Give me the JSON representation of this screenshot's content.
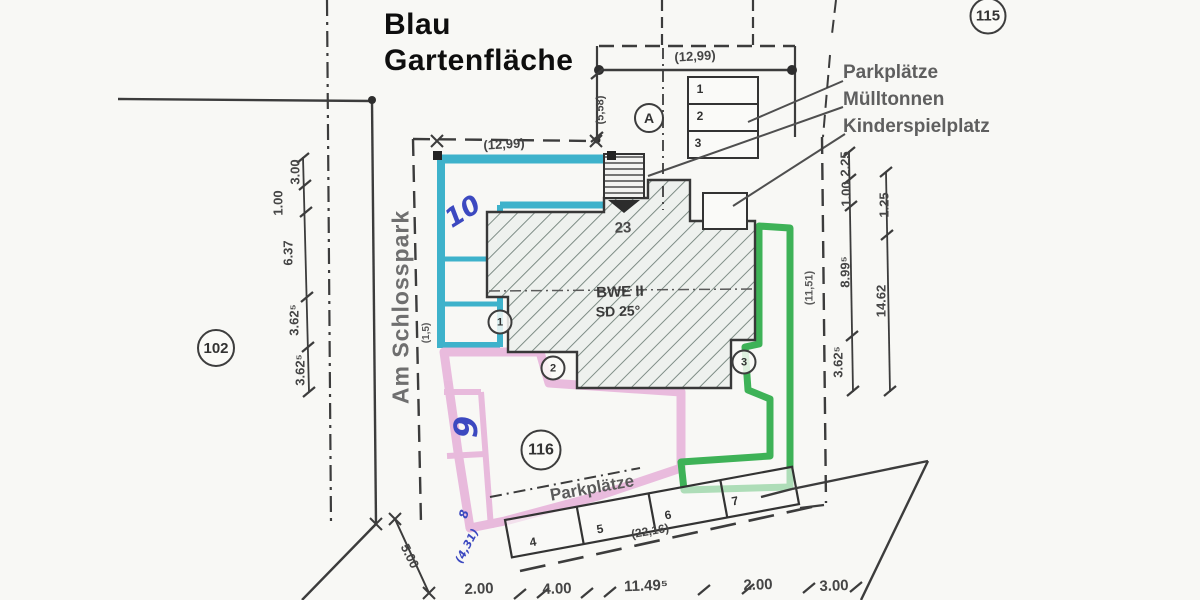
{
  "annotation": {
    "line1": "Blau",
    "line2": "Gartenfläche"
  },
  "street": {
    "name": "Am Schlosspark",
    "corner_dim": "5.00",
    "width_dim": "(1,5)"
  },
  "parcels": {
    "p115": "115",
    "p102": "102",
    "p116": "116"
  },
  "legend": {
    "parkplaetze": "Parkplätze",
    "muelltonnen": "Mülltonnen",
    "kinderspielplatz": "Kinderspielplatz"
  },
  "building": {
    "number": "23",
    "name": "BWE II",
    "roof": "SD 25°",
    "section": "A",
    "units": {
      "u1": "1",
      "u2": "2",
      "u3": "3"
    }
  },
  "parking_top": {
    "dim": "(12,99)",
    "side_dim": "(5,58)",
    "stalls": {
      "s1": "1",
      "s2": "2",
      "s3": "3"
    }
  },
  "parking_bottom": {
    "label": "Parkplätze",
    "dim": "(22,16)",
    "stalls": {
      "s4": "4",
      "s5": "5",
      "s6": "6",
      "s7": "7"
    }
  },
  "garden": {
    "top_dim": "(12,99)",
    "plot10": "10",
    "plot9": "9",
    "plot8": "8",
    "blue_dim": "(4,31)"
  },
  "dims": {
    "left": {
      "d1": "3.00",
      "d2": "1.00",
      "d3": "6.37",
      "d4": "3.62⁵",
      "d5": "3.62⁵"
    },
    "right_inner": {
      "d1": "2.25",
      "d2": "1.00",
      "d3": "8.99⁵",
      "d4": "3.62⁵"
    },
    "right_outer": {
      "d1": "1.25",
      "d2": "14.62"
    },
    "bottom": {
      "d1": "2.00",
      "d2": "4.00",
      "d3": "11.49⁵",
      "d4": "2.00",
      "d5": "3.00"
    },
    "mid_right": "(11,51)"
  }
}
